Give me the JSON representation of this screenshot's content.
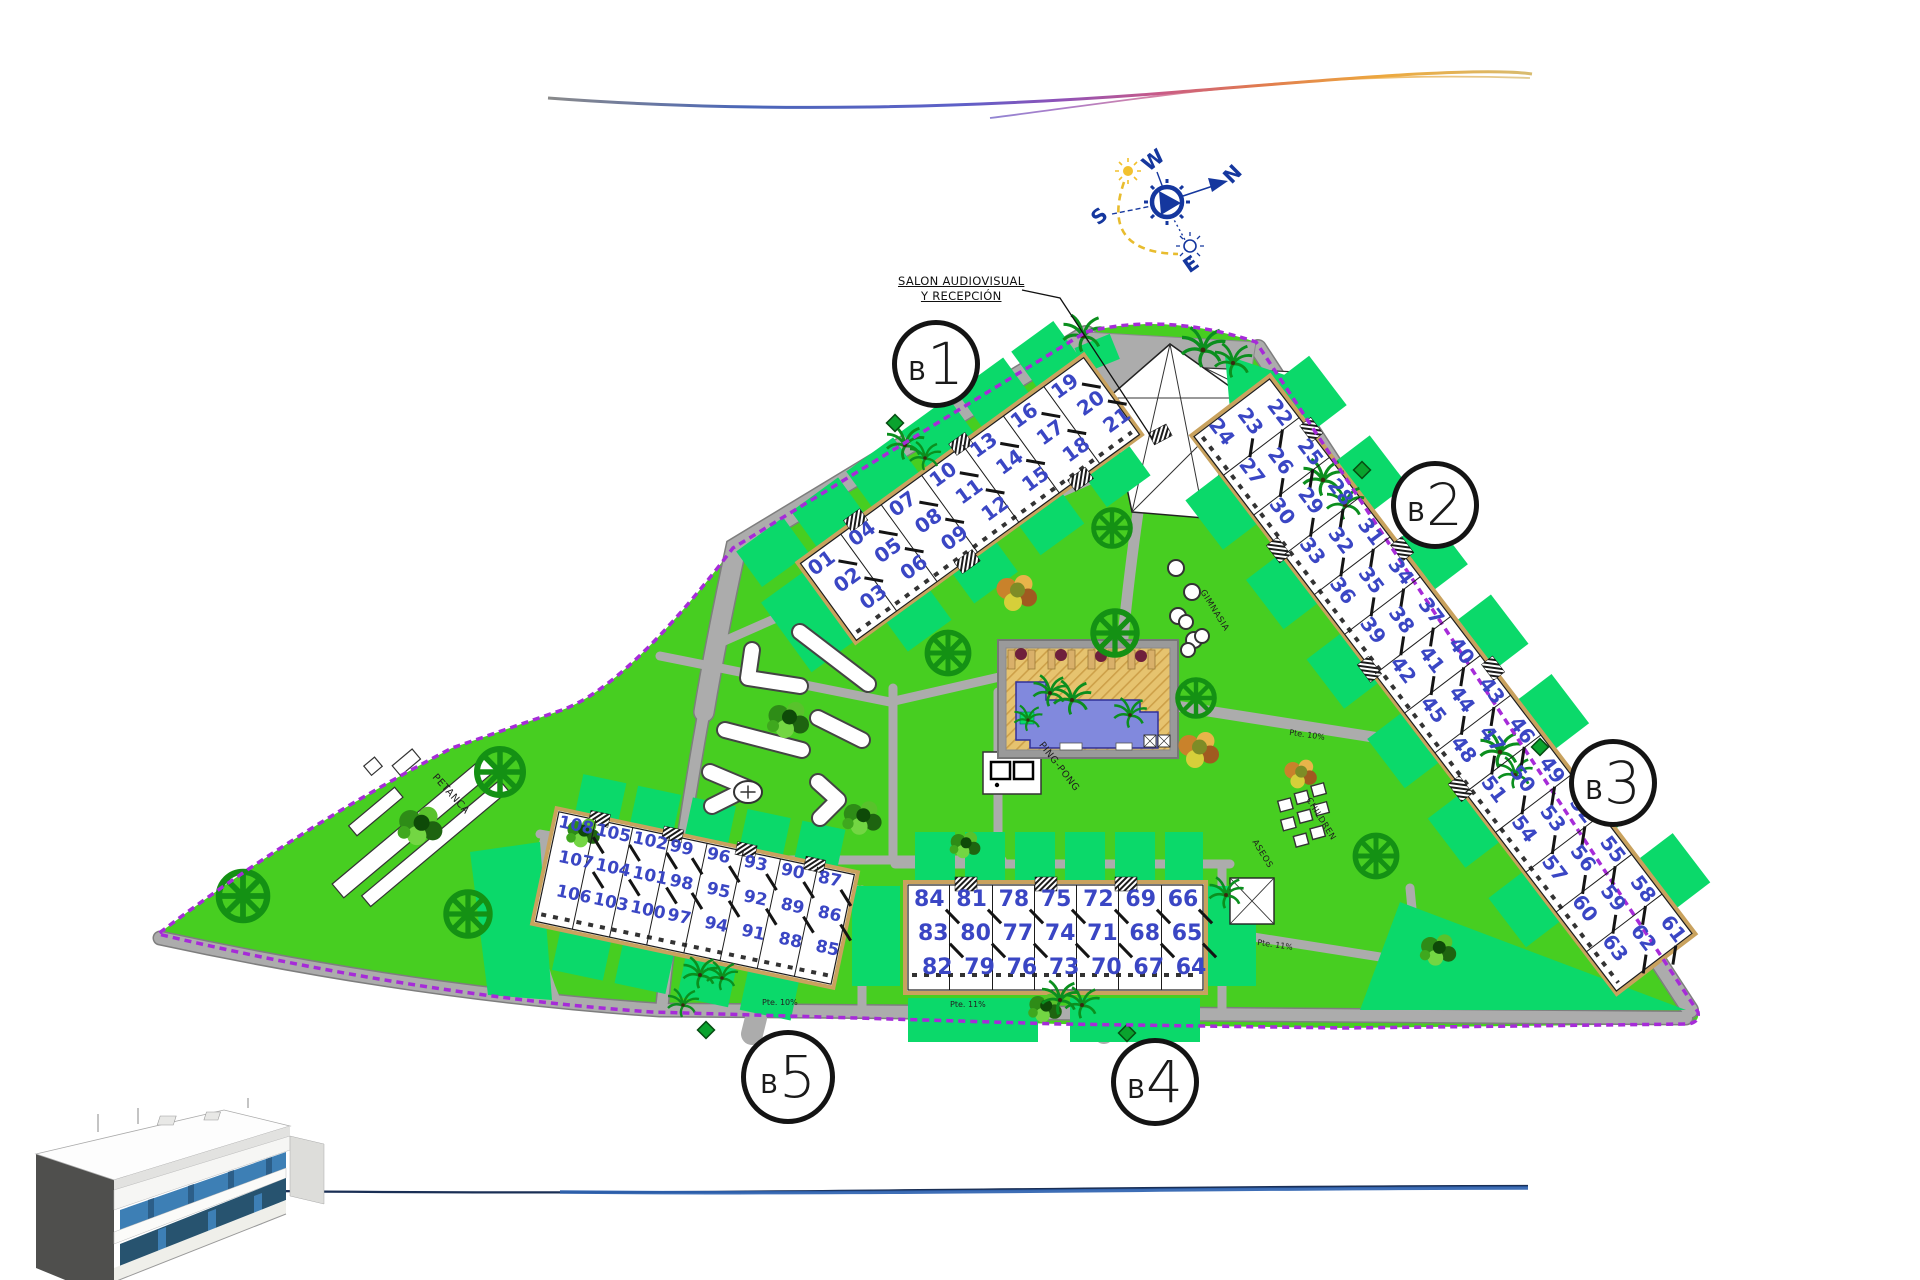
{
  "site": {
    "blocks": [
      {
        "prefix": "B",
        "number": "1"
      },
      {
        "prefix": "B",
        "number": "2"
      },
      {
        "prefix": "B",
        "number": "3"
      },
      {
        "prefix": "B",
        "number": "4"
      },
      {
        "prefix": "B",
        "number": "5"
      }
    ],
    "annotation": {
      "line1": "SALON AUDIOVISUAL",
      "line2": "Y RECEPCIÓN"
    },
    "areas": {
      "petanca": "PETANCA",
      "pingpong": "PING-PONG",
      "gimnasia": "GIMNASIA",
      "children": "CHILDREN",
      "aseos": "ASEOS"
    },
    "compass": {
      "n": "N",
      "s": "S",
      "e": "E",
      "w": "W"
    },
    "slopes": [
      {
        "text": "Pte. 10%"
      },
      {
        "text": "Pte. 11%"
      },
      {
        "text": "Pte. 11%"
      },
      {
        "text": "Pte. 10%"
      }
    ],
    "buildings": {
      "b1": {
        "groups": [
          [
            "01",
            "02",
            "03"
          ],
          [
            "04",
            "05",
            "06"
          ],
          [
            "07",
            "08",
            "09"
          ],
          [
            "10",
            "11",
            "12"
          ],
          [
            "13",
            "14",
            "15"
          ],
          [
            "16",
            "17",
            "18"
          ],
          [
            "19",
            "20",
            "21"
          ]
        ]
      },
      "b2b3": {
        "groups": [
          [
            "22",
            "23",
            "24"
          ],
          [
            "25",
            "26",
            "27"
          ],
          [
            "28",
            "29",
            "30"
          ],
          [
            "31",
            "32",
            "33"
          ],
          [
            "34",
            "35",
            "36"
          ],
          [
            "37",
            "38",
            "39"
          ],
          [
            "40",
            "41",
            "42"
          ],
          [
            "43",
            "44",
            "45"
          ],
          [
            "46",
            "47",
            "48"
          ],
          [
            "49",
            "50",
            "51"
          ],
          [
            "52",
            "53",
            "54"
          ],
          [
            "55",
            "56",
            "57"
          ],
          [
            "58",
            "59",
            "60"
          ],
          [
            "61",
            "62",
            "63"
          ]
        ]
      },
      "b4": {
        "groups": [
          [
            "84",
            "83",
            "82"
          ],
          [
            "81",
            "80",
            "79"
          ],
          [
            "78",
            "77",
            "76"
          ],
          [
            "75",
            "74",
            "73"
          ],
          [
            "72",
            "71",
            "70"
          ],
          [
            "69",
            "68",
            "67"
          ],
          [
            "66",
            "65",
            "64"
          ]
        ]
      },
      "b5": {
        "groups": [
          [
            "108",
            "107",
            "106"
          ],
          [
            "105",
            "104",
            "103"
          ],
          [
            "102",
            "101",
            "100"
          ],
          [
            "99",
            "98",
            "97"
          ],
          [
            "96",
            "95",
            "94"
          ],
          [
            "93",
            "92",
            "91"
          ],
          [
            "90",
            "89",
            "88"
          ],
          [
            "87",
            "86",
            "85"
          ]
        ]
      }
    },
    "colors": {
      "lawn": "#47CE21",
      "parcel": "#0BD96A",
      "road": "#ACACAC",
      "boundary": "#A62BD8",
      "unit_number": "#3A46C4",
      "pool_water": "#8189DD",
      "pool_deck": "#E6C36F",
      "compass_blue": "#15379E"
    }
  }
}
